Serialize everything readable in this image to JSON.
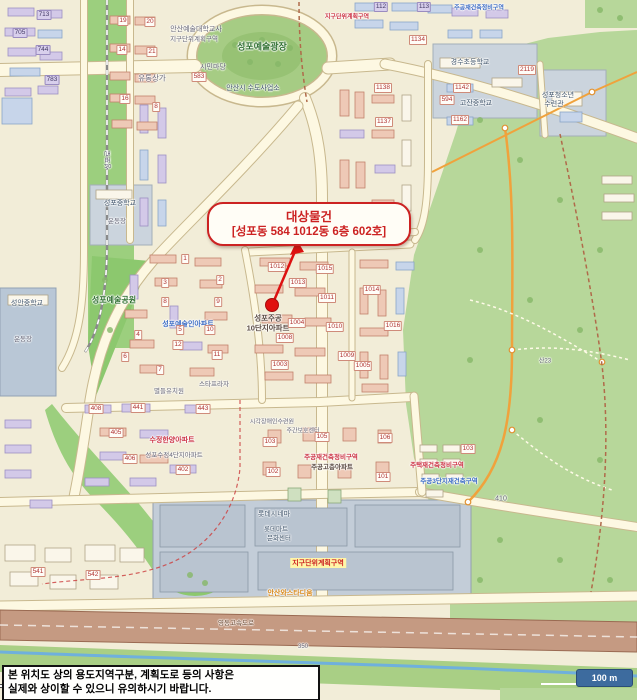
{
  "window": {
    "width": 637,
    "height": 700
  },
  "callout": {
    "title": "대상물건",
    "subtitle": "[성포동 584 1012동 6층 602호]"
  },
  "marker": {
    "kind": "red-dot-with-arrow"
  },
  "disclaimer": {
    "line1": "본 위치도 상의 용도지역구분, 계획도로 등의 사항은",
    "line2": "실제와 상이할 수 있으니 유의하시기 바랍니다."
  },
  "scale_bar": {
    "label": "100 m"
  },
  "colors": {
    "land": "#f2edd8",
    "park": "#b7d79a",
    "park_bright": "#8cc86e",
    "road": "#fdf8e2",
    "road_casing": "#c8b88e",
    "highway": "#c59a82",
    "water": "#6fb0dd",
    "school_area": "#cbd4dd",
    "commercial_area": "#c3cdd8",
    "callout_red": "#cc2222",
    "marker_red": "#e01010",
    "scalebar_blue": "#3d6b9e",
    "trail_orange": "#f0a23c"
  },
  "map": {
    "labels": [
      {
        "t": "성포예술광장",
        "k": "grn",
        "x": 262,
        "y": 46,
        "s": 9
      },
      {
        "t": "안산예술대학교사",
        "k": "gray",
        "x": 196,
        "y": 29,
        "s": 7
      },
      {
        "t": "지구단위계획구역",
        "k": "gray",
        "x": 194,
        "y": 38,
        "s": 6.5
      },
      {
        "t": "유통상가",
        "k": "gray",
        "x": 152,
        "y": 78,
        "s": 7.5
      },
      {
        "t": "시민마당",
        "k": "gray",
        "x": 213,
        "y": 67,
        "s": 7
      },
      {
        "t": "583",
        "k": "chip",
        "x": 199,
        "y": 77
      },
      {
        "t": "안산시 수도사업소",
        "k": "sch",
        "x": 253,
        "y": 88,
        "s": 7
      },
      {
        "t": "경수초등학교",
        "k": "sch",
        "x": 470,
        "y": 62,
        "s": 7
      },
      {
        "t": "594",
        "k": "chip",
        "x": 447,
        "y": 100
      },
      {
        "t": "고잔중학교",
        "k": "sch",
        "x": 476,
        "y": 103,
        "s": 7
      },
      {
        "t": "성포청소년",
        "k": "sch",
        "x": 558,
        "y": 95,
        "s": 7
      },
      {
        "t": "수련관",
        "k": "sch",
        "x": 554,
        "y": 104,
        "s": 7
      },
      {
        "t": "2119",
        "k": "chip",
        "x": 527,
        "y": 70
      },
      {
        "t": "713",
        "k": "chipP",
        "x": 44,
        "y": 15
      },
      {
        "t": "705",
        "k": "chipP",
        "x": 20,
        "y": 33
      },
      {
        "t": "744",
        "k": "chipP",
        "x": 43,
        "y": 50
      },
      {
        "t": "783",
        "k": "chipP",
        "x": 52,
        "y": 80
      },
      {
        "t": "112",
        "k": "chipP",
        "x": 381,
        "y": 7
      },
      {
        "t": "113",
        "k": "chipP",
        "x": 424,
        "y": 7
      },
      {
        "t": "1134",
        "k": "chip",
        "x": 418,
        "y": 40
      },
      {
        "t": "1138",
        "k": "chip",
        "x": 383,
        "y": 88
      },
      {
        "t": "1137",
        "k": "chip",
        "x": 384,
        "y": 122
      },
      {
        "t": "1142",
        "k": "chip",
        "x": 462,
        "y": 88
      },
      {
        "t": "1162",
        "k": "chip",
        "x": 460,
        "y": 120
      },
      {
        "t": "19",
        "k": "chip",
        "x": 123,
        "y": 21
      },
      {
        "t": "20",
        "k": "chip",
        "x": 150,
        "y": 22
      },
      {
        "t": "14",
        "k": "chip",
        "x": 122,
        "y": 50
      },
      {
        "t": "21",
        "k": "chip",
        "x": 152,
        "y": 52
      },
      {
        "t": "16",
        "k": "chip",
        "x": 125,
        "y": 99
      },
      {
        "t": "8",
        "k": "chip",
        "x": 156,
        "y": 107
      },
      {
        "t": "성포로",
        "k": "gray",
        "x": 108,
        "y": 160,
        "s": 7,
        "r": -90
      },
      {
        "t": "성포중학교",
        "k": "sch",
        "x": 120,
        "y": 203,
        "s": 7
      },
      {
        "t": "운동장",
        "k": "gray",
        "x": 117,
        "y": 220,
        "s": 6.5
      },
      {
        "t": "성안중학교",
        "k": "sch",
        "x": 27,
        "y": 303,
        "s": 7
      },
      {
        "t": "운동장",
        "k": "gray",
        "x": 23,
        "y": 338,
        "s": 6.5
      },
      {
        "t": "성포예술공원",
        "k": "grn",
        "x": 114,
        "y": 300,
        "s": 8
      },
      {
        "t": "성포예술인아파트",
        "k": "blue",
        "x": 188,
        "y": 324,
        "s": 7
      },
      {
        "t": "1",
        "k": "chip",
        "x": 185,
        "y": 259
      },
      {
        "t": "2",
        "k": "chip",
        "x": 220,
        "y": 280
      },
      {
        "t": "3",
        "k": "chip",
        "x": 165,
        "y": 283
      },
      {
        "t": "8",
        "k": "chip",
        "x": 165,
        "y": 302
      },
      {
        "t": "9",
        "k": "chip",
        "x": 218,
        "y": 302
      },
      {
        "t": "5",
        "k": "chip",
        "x": 180,
        "y": 330
      },
      {
        "t": "10",
        "k": "chip",
        "x": 210,
        "y": 330
      },
      {
        "t": "4",
        "k": "chip",
        "x": 138,
        "y": 335
      },
      {
        "t": "12",
        "k": "chip",
        "x": 178,
        "y": 345
      },
      {
        "t": "6",
        "k": "chip",
        "x": 125,
        "y": 357
      },
      {
        "t": "7",
        "k": "chip",
        "x": 160,
        "y": 370
      },
      {
        "t": "11",
        "k": "chip",
        "x": 217,
        "y": 355
      },
      {
        "t": "스타프라자",
        "k": "gray",
        "x": 214,
        "y": 383,
        "s": 6.5
      },
      {
        "t": "별들유치원",
        "k": "gray",
        "x": 169,
        "y": 390,
        "s": 6.5
      },
      {
        "t": "성포주공",
        "k": "dark",
        "x": 268,
        "y": 318,
        "s": 7.5
      },
      {
        "t": "10단지아파트",
        "k": "dark",
        "x": 268,
        "y": 328,
        "s": 7.5
      },
      {
        "t": "1012",
        "k": "chip",
        "x": 277,
        "y": 267
      },
      {
        "t": "1013",
        "k": "chip",
        "x": 298,
        "y": 283
      },
      {
        "t": "1015",
        "k": "chip",
        "x": 325,
        "y": 269
      },
      {
        "t": "1011",
        "k": "chip",
        "x": 327,
        "y": 298
      },
      {
        "t": "1004",
        "k": "chip",
        "x": 297,
        "y": 323
      },
      {
        "t": "1010",
        "k": "chip",
        "x": 335,
        "y": 327
      },
      {
        "t": "1008",
        "k": "chip",
        "x": 285,
        "y": 338
      },
      {
        "t": "1003",
        "k": "chip",
        "x": 280,
        "y": 365
      },
      {
        "t": "1009",
        "k": "chip",
        "x": 347,
        "y": 356
      },
      {
        "t": "1005",
        "k": "chip",
        "x": 363,
        "y": 366
      },
      {
        "t": "1014",
        "k": "chip",
        "x": 372,
        "y": 290
      },
      {
        "t": "1016",
        "k": "chip",
        "x": 393,
        "y": 326
      },
      {
        "t": "수정한양아파트",
        "k": "red",
        "x": 172,
        "y": 440,
        "s": 7
      },
      {
        "t": "성포수정4단지아파트",
        "k": "gray",
        "x": 174,
        "y": 454,
        "s": 6.5
      },
      {
        "t": "408",
        "k": "chip",
        "x": 96,
        "y": 409
      },
      {
        "t": "441",
        "k": "chip",
        "x": 138,
        "y": 408
      },
      {
        "t": "443",
        "k": "chip",
        "x": 203,
        "y": 409
      },
      {
        "t": "405",
        "k": "chip",
        "x": 116,
        "y": 433
      },
      {
        "t": "406",
        "k": "chip",
        "x": 130,
        "y": 459
      },
      {
        "t": "402",
        "k": "chip",
        "x": 183,
        "y": 470
      },
      {
        "t": "시각장애인수련원",
        "k": "gray",
        "x": 272,
        "y": 421,
        "s": 6
      },
      {
        "t": "주간보호센터",
        "k": "gray",
        "x": 303,
        "y": 430,
        "s": 6
      },
      {
        "t": "주공재건축정비구역",
        "k": "red",
        "x": 331,
        "y": 456,
        "s": 6.5
      },
      {
        "t": "주공고층아파트",
        "k": "dark",
        "x": 332,
        "y": 466,
        "s": 6.5
      },
      {
        "t": "103",
        "k": "chip",
        "x": 270,
        "y": 442
      },
      {
        "t": "105",
        "k": "chip",
        "x": 322,
        "y": 437
      },
      {
        "t": "106",
        "k": "chip",
        "x": 385,
        "y": 438
      },
      {
        "t": "102",
        "k": "chip",
        "x": 273,
        "y": 472
      },
      {
        "t": "101",
        "k": "chip",
        "x": 383,
        "y": 477
      },
      {
        "t": "주택재건축정비구역",
        "k": "red",
        "x": 437,
        "y": 464,
        "s": 6.5
      },
      {
        "t": "주공3단지재건축구역",
        "k": "blue",
        "x": 449,
        "y": 480,
        "s": 6.5
      },
      {
        "t": "103",
        "k": "chip",
        "x": 468,
        "y": 449
      },
      {
        "t": "롯데시네마",
        "k": "sch",
        "x": 274,
        "y": 514,
        "s": 7
      },
      {
        "t": "롯데마트",
        "k": "sch",
        "x": 276,
        "y": 528,
        "s": 6.5
      },
      {
        "t": "문화센터",
        "k": "sch",
        "x": 279,
        "y": 537,
        "s": 6.5
      },
      {
        "t": "지구단위계획구역",
        "k": "hl",
        "x": 318,
        "y": 563,
        "s": 7
      },
      {
        "t": "안산와스타디움",
        "k": "org",
        "x": 290,
        "y": 593,
        "s": 7
      },
      {
        "t": "영동고속도로",
        "k": "wht",
        "x": 236,
        "y": 622,
        "s": 6.5
      },
      {
        "t": "541",
        "k": "chip",
        "x": 38,
        "y": 572
      },
      {
        "t": "542",
        "k": "chip",
        "x": 93,
        "y": 575
      },
      {
        "t": "350",
        "k": "gray",
        "x": 303,
        "y": 647,
        "s": 6
      },
      {
        "t": "410",
        "k": "gray",
        "x": 501,
        "y": 499,
        "s": 7
      },
      {
        "t": "산23",
        "k": "gray",
        "x": 545,
        "y": 360,
        "s": 6
      },
      {
        "t": "지구단위계획구역",
        "k": "red",
        "x": 347,
        "y": 16,
        "s": 6
      },
      {
        "t": "주공재건축정비구역",
        "k": "blue",
        "x": 479,
        "y": 7,
        "s": 6
      }
    ]
  }
}
